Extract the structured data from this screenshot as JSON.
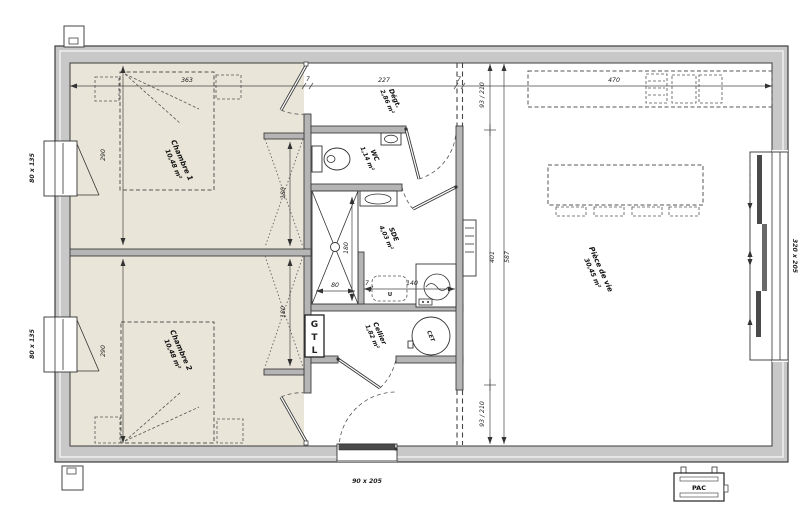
{
  "rooms": {
    "chambre1": {
      "name": "Chambre 1",
      "area": "10,48 m²"
    },
    "chambre2": {
      "name": "Chambre 2",
      "area": "10,48 m²"
    },
    "degagement": {
      "name": "Dégt.",
      "area": "2,86 m²"
    },
    "wc": {
      "name": "WC",
      "area": "1,14 m²"
    },
    "sde": {
      "name": "SDE",
      "area": "4,03 m²"
    },
    "cellier": {
      "name": "Cellier",
      "area": "1,82 m²"
    },
    "piece_de_vie": {
      "name": "Pièce de vie",
      "area": "30,45 m²"
    }
  },
  "equipment": {
    "gtl_letters": [
      "G",
      "T",
      "L"
    ],
    "cet": "CET",
    "pac": "PAC",
    "appliance_slot": "U"
  },
  "openings": {
    "window_small": "80 x 135",
    "entry_door": "90 x 205",
    "bay_window": "320 x 205"
  },
  "dims": {
    "d363": "363",
    "d7": "7",
    "d227": "227",
    "d470": "470",
    "d290": "290",
    "d180": "180",
    "d80": "80",
    "d140": "140",
    "d93_210": "93 / 210",
    "d401": "401",
    "d587": "587"
  },
  "colors": {
    "wall": "#c8c8c8",
    "partition": "#b5b5b5",
    "bedroom_floor": "#e9e5d8",
    "line": "#3a3a3a"
  }
}
